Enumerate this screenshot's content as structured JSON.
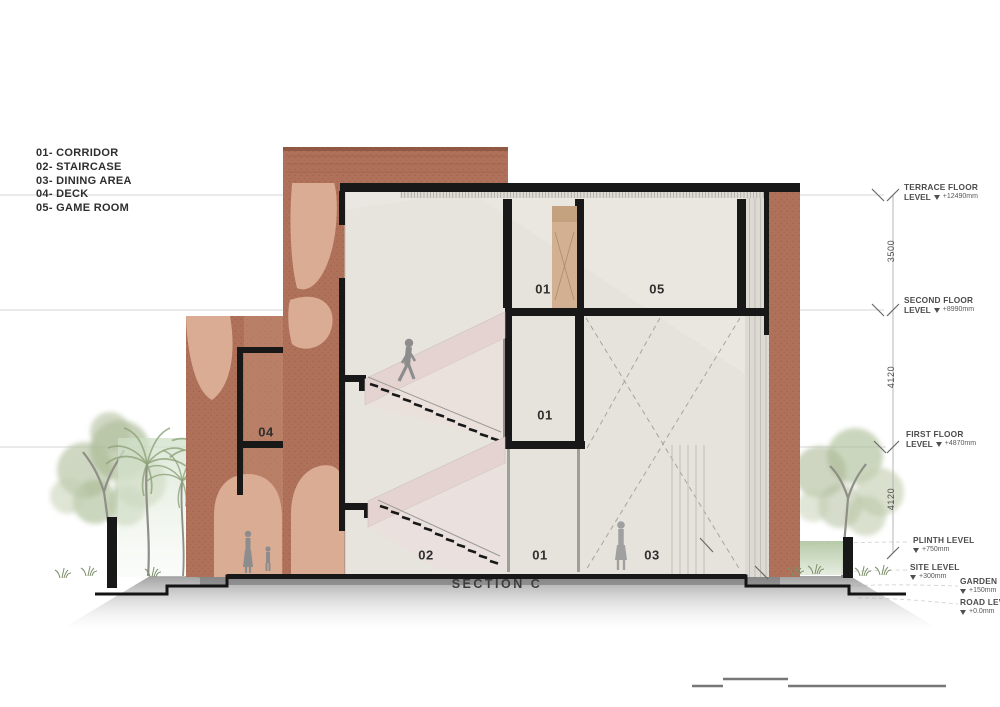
{
  "title": {
    "section_label": "SECTION C"
  },
  "legend": {
    "items": [
      "01- CORRIDOR",
      "02- STAIRCASE",
      "03- DINING AREA",
      "04- DECK",
      "05- GAME ROOM"
    ]
  },
  "room_labels": {
    "deck": "04",
    "top_corridor": "01",
    "game_room": "05",
    "mid_corridor": "01",
    "ground_staircase": "02",
    "ground_corridor": "01",
    "dining": "03"
  },
  "levels": [
    {
      "id": "terrace",
      "line1": "TERRACE FLOOR",
      "line2": "LEVEL",
      "value": "+12490mm"
    },
    {
      "id": "second",
      "line1": "SECOND FLOOR",
      "line2": "LEVEL",
      "value": "+8990mm"
    },
    {
      "id": "first",
      "line1": "FIRST FLOOR",
      "line2": "LEVEL",
      "value": "+4870mm"
    },
    {
      "id": "plinth",
      "line1": "PLINTH LEVEL",
      "line2": "",
      "value": "+750mm"
    },
    {
      "id": "site",
      "line1": "SITE LEVEL",
      "line2": "",
      "value": "+300mm"
    },
    {
      "id": "garden",
      "line1": "GARDEN LEVEL",
      "line2": "",
      "value": "+150mm"
    },
    {
      "id": "road",
      "line1": "ROAD LEVEL",
      "line2": "",
      "value": "+0.0mm"
    }
  ],
  "dimensions": [
    "3500",
    "4120",
    "4120"
  ],
  "icons": {
    "level_marker": "triangle-down-level-marker"
  },
  "colors": {
    "bg": "#ffffff",
    "brick": "#b0715a",
    "brick_dark": "#96604a",
    "brick_light": "#c89078",
    "arch": "#d9ac93",
    "interior": "#eae7e1",
    "stair_pink": "#e5d3d1",
    "ink": "#181818",
    "text": "#3d3d3d",
    "tree": "#aebd9a",
    "palm": "#8da379",
    "glass": "#dcdad3",
    "door": "#d3b091",
    "shadow": "#8c8c8c"
  }
}
